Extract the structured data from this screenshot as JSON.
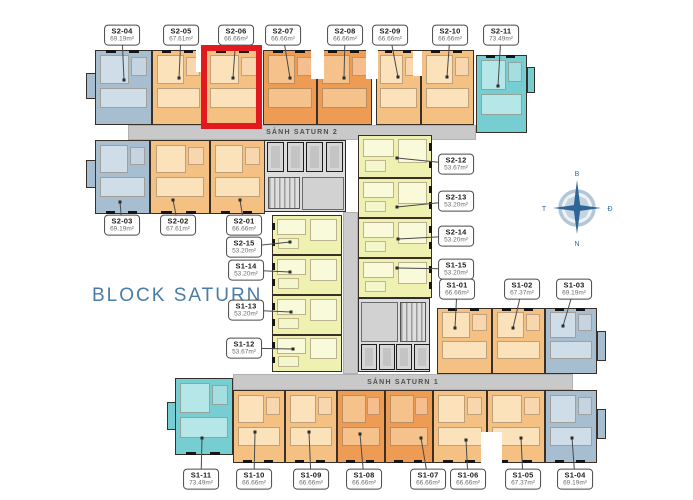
{
  "title": "BLOCK SATURN",
  "compass": {
    "north": "B",
    "east": "Đ",
    "south": "N",
    "west": "T"
  },
  "highlight": {
    "unit": "S2-06",
    "color": "#e2191f",
    "x": 201,
    "y": 45,
    "w": 61,
    "h": 84
  },
  "halls": [
    {
      "label": "SẢNH SATURN 2",
      "x": 128,
      "y": 125,
      "w": 348,
      "h": 15
    },
    {
      "label": "SẢNH SATURN 1",
      "x": 233,
      "y": 374,
      "w": 340,
      "h": 16
    }
  ],
  "corridor": {
    "x": 343,
    "y": 212,
    "w": 15,
    "h": 162
  },
  "colors": {
    "blue": "#a6bed0",
    "blue_light": "#cfdde8",
    "tan": "#f4c183",
    "tan_light": "#fbe2ba",
    "orange": "#ee9c54",
    "orange_light": "#f6c28b",
    "teal": "#76cdd2",
    "teal_light": "#b5e6e8",
    "yellow": "#eff1b0",
    "yellow_light": "#f9fad9",
    "hall": "#c9c9c9",
    "core": "#dcdcdc",
    "wall": "#3a2f26",
    "red": "#e2191f",
    "brand": "#4b7ca6"
  },
  "units": [
    {
      "code": "S2-04",
      "area": "69.19m²",
      "color": "blue",
      "x": 95,
      "y": 50,
      "w": 57,
      "h": 75,
      "facade": "top",
      "label": {
        "x": 122,
        "y": 35
      },
      "dot": {
        "x": 124,
        "y": 80
      }
    },
    {
      "code": "S2-05",
      "area": "67.61m²",
      "color": "tan",
      "x": 152,
      "y": 50,
      "w": 53,
      "h": 75,
      "facade": "top",
      "label": {
        "x": 181,
        "y": 35
      },
      "dot": {
        "x": 179,
        "y": 78
      }
    },
    {
      "code": "S2-06",
      "area": "66.66m²",
      "color": "tan",
      "x": 205,
      "y": 50,
      "w": 57,
      "h": 75,
      "facade": "top",
      "label": {
        "x": 236,
        "y": 35
      },
      "dot": {
        "x": 233,
        "y": 78
      }
    },
    {
      "code": "S2-07",
      "area": "66.66m²",
      "color": "orange",
      "x": 263,
      "y": 50,
      "w": 54,
      "h": 75,
      "facade": "top",
      "label": {
        "x": 283,
        "y": 35
      },
      "dot": {
        "x": 290,
        "y": 78
      }
    },
    {
      "code": "S2-08",
      "area": "66.66m²",
      "color": "orange",
      "x": 317,
      "y": 50,
      "w": 55,
      "h": 75,
      "facade": "top",
      "label": {
        "x": 345,
        "y": 35
      },
      "dot": {
        "x": 344,
        "y": 78
      }
    },
    {
      "code": "S2-09",
      "area": "66.66m²",
      "color": "tan",
      "x": 376,
      "y": 50,
      "w": 45,
      "h": 75,
      "facade": "top",
      "label": {
        "x": 390,
        "y": 35
      },
      "dot": {
        "x": 398,
        "y": 77
      }
    },
    {
      "code": "S2-10",
      "area": "66.66m²",
      "color": "tan",
      "x": 421,
      "y": 50,
      "w": 53,
      "h": 75,
      "facade": "top",
      "label": {
        "x": 450,
        "y": 35
      },
      "dot": {
        "x": 447,
        "y": 77
      }
    },
    {
      "code": "S2-11",
      "area": "73.49m²",
      "color": "teal",
      "x": 476,
      "y": 55,
      "w": 51,
      "h": 78,
      "facade": "top",
      "label": {
        "x": 501,
        "y": 35
      },
      "dot": {
        "x": 498,
        "y": 86
      }
    },
    {
      "code": "S2-03",
      "area": "69.19m²",
      "color": "blue",
      "x": 95,
      "y": 140,
      "w": 55,
      "h": 74,
      "facade": "bottom",
      "label": {
        "x": 122,
        "y": 225
      },
      "dot": {
        "x": 120,
        "y": 202
      }
    },
    {
      "code": "S2-02",
      "area": "67.61m²",
      "color": "tan",
      "x": 150,
      "y": 140,
      "w": 60,
      "h": 74,
      "facade": "bottom",
      "label": {
        "x": 178,
        "y": 225
      },
      "dot": {
        "x": 173,
        "y": 200
      }
    },
    {
      "code": "S2-01",
      "area": "66.66m²",
      "color": "tan",
      "x": 210,
      "y": 140,
      "w": 55,
      "h": 74,
      "facade": "bottom",
      "label": {
        "x": 244,
        "y": 225
      },
      "dot": {
        "x": 240,
        "y": 200
      }
    },
    {
      "code": "S2-15",
      "area": "53.20m²",
      "color": "yellow",
      "x": 272,
      "y": 215,
      "w": 70,
      "h": 40,
      "facade": "left",
      "label": {
        "x": 244,
        "y": 247
      },
      "dot": {
        "x": 290,
        "y": 242
      }
    },
    {
      "code": "S1-14",
      "area": "53.20m²",
      "color": "yellow",
      "x": 272,
      "y": 255,
      "w": 70,
      "h": 40,
      "facade": "left",
      "label": {
        "x": 246,
        "y": 270
      },
      "dot": {
        "x": 290,
        "y": 272
      }
    },
    {
      "code": "S1-13",
      "area": "53.20m²",
      "color": "yellow",
      "x": 272,
      "y": 295,
      "w": 70,
      "h": 40,
      "facade": "left",
      "label": {
        "x": 246,
        "y": 310
      },
      "dot": {
        "x": 291,
        "y": 312
      }
    },
    {
      "code": "S1-12",
      "area": "53.67m²",
      "color": "yellow",
      "x": 272,
      "y": 335,
      "w": 70,
      "h": 37,
      "facade": "left",
      "label": {
        "x": 244,
        "y": 348
      },
      "dot": {
        "x": 293,
        "y": 349
      }
    },
    {
      "code": "S2-12",
      "area": "53.67m²",
      "color": "yellow",
      "x": 358,
      "y": 135,
      "w": 74,
      "h": 43,
      "facade": "right",
      "label": {
        "x": 456,
        "y": 164
      },
      "dot": {
        "x": 397,
        "y": 158
      }
    },
    {
      "code": "S2-13",
      "area": "53.20m²",
      "color": "yellow",
      "x": 358,
      "y": 178,
      "w": 74,
      "h": 40,
      "facade": "right",
      "label": {
        "x": 456,
        "y": 201
      },
      "dot": {
        "x": 397,
        "y": 207
      }
    },
    {
      "code": "S2-14",
      "area": "53.20m²",
      "color": "yellow",
      "x": 358,
      "y": 218,
      "w": 74,
      "h": 40,
      "facade": "right",
      "label": {
        "x": 456,
        "y": 236
      },
      "dot": {
        "x": 398,
        "y": 239
      }
    },
    {
      "code": "S1-15",
      "area": "53.20m²",
      "color": "yellow",
      "x": 358,
      "y": 258,
      "w": 74,
      "h": 40,
      "facade": "right",
      "label": {
        "x": 456,
        "y": 269
      },
      "dot": {
        "x": 397,
        "y": 268
      }
    },
    {
      "code": "S1-01",
      "area": "66.66m²",
      "color": "tan",
      "x": 437,
      "y": 308,
      "w": 55,
      "h": 66,
      "facade": "top",
      "label": {
        "x": 457,
        "y": 289
      },
      "dot": {
        "x": 455,
        "y": 328
      }
    },
    {
      "code": "S1-02",
      "area": "67.37m²",
      "color": "tan",
      "x": 492,
      "y": 308,
      "w": 53,
      "h": 66,
      "facade": "top",
      "label": {
        "x": 522,
        "y": 289
      },
      "dot": {
        "x": 513,
        "y": 328
      }
    },
    {
      "code": "S1-03",
      "area": "69.19m²",
      "color": "blue",
      "x": 545,
      "y": 308,
      "w": 52,
      "h": 66,
      "facade": "top",
      "label": {
        "x": 574,
        "y": 289
      },
      "dot": {
        "x": 563,
        "y": 326
      }
    },
    {
      "code": "S1-11",
      "area": "73.49m²",
      "color": "teal",
      "x": 175,
      "y": 378,
      "w": 58,
      "h": 77,
      "facade": "bottom",
      "label": {
        "x": 201,
        "y": 479
      },
      "dot": {
        "x": 202,
        "y": 438
      }
    },
    {
      "code": "S1-10",
      "area": "66.66m²",
      "color": "tan",
      "x": 233,
      "y": 390,
      "w": 52,
      "h": 73,
      "facade": "bottom",
      "label": {
        "x": 254,
        "y": 479
      },
      "dot": {
        "x": 255,
        "y": 432
      }
    },
    {
      "code": "S1-09",
      "area": "66.66m²",
      "color": "tan",
      "x": 285,
      "y": 390,
      "w": 52,
      "h": 73,
      "facade": "bottom",
      "label": {
        "x": 311,
        "y": 479
      },
      "dot": {
        "x": 309,
        "y": 432
      }
    },
    {
      "code": "S1-08",
      "area": "66.66m²",
      "color": "orange",
      "x": 337,
      "y": 390,
      "w": 48,
      "h": 73,
      "facade": "bottom",
      "label": {
        "x": 364,
        "y": 479
      },
      "dot": {
        "x": 360,
        "y": 434
      }
    },
    {
      "code": "S1-07",
      "area": "66.66m²",
      "color": "orange",
      "x": 385,
      "y": 390,
      "w": 48,
      "h": 73,
      "facade": "bottom",
      "label": {
        "x": 428,
        "y": 479
      },
      "dot": {
        "x": 421,
        "y": 438
      }
    },
    {
      "code": "S1-06",
      "area": "66.66m²",
      "color": "tan",
      "x": 433,
      "y": 390,
      "w": 54,
      "h": 73,
      "facade": "bottom",
      "label": {
        "x": 468,
        "y": 479
      },
      "dot": {
        "x": 466,
        "y": 440
      }
    },
    {
      "code": "S1-05",
      "area": "67.37m²",
      "color": "tan",
      "x": 487,
      "y": 390,
      "w": 58,
      "h": 73,
      "facade": "bottom",
      "label": {
        "x": 523,
        "y": 479
      },
      "dot": {
        "x": 521,
        "y": 438
      }
    },
    {
      "code": "S1-04",
      "area": "69.19m²",
      "color": "blue",
      "x": 545,
      "y": 390,
      "w": 52,
      "h": 73,
      "facade": "bottom",
      "label": {
        "x": 575,
        "y": 479
      },
      "dot": {
        "x": 572,
        "y": 438
      }
    }
  ],
  "cores": [
    {
      "x": 264,
      "y": 140,
      "w": 82,
      "h": 72,
      "elevators": {
        "x": 267,
        "y": 142,
        "count": 4,
        "cw": 17,
        "ch": 30,
        "gap": 19.5
      },
      "stairs": {
        "x": 268,
        "y": 177,
        "w": 32,
        "h": 32
      },
      "room": {
        "x": 302,
        "y": 177,
        "w": 42,
        "h": 33
      }
    },
    {
      "x": 358,
      "y": 298,
      "w": 72,
      "h": 74,
      "elevators": {
        "x": 361,
        "y": 344,
        "count": 4,
        "cw": 16,
        "ch": 26,
        "gap": 17.5
      },
      "stairs": {
        "x": 400,
        "y": 302,
        "w": 26,
        "h": 40
      },
      "room": {
        "x": 361,
        "y": 302,
        "w": 37,
        "h": 40
      }
    }
  ],
  "nubs": [
    {
      "color": "blue",
      "x": 86,
      "y": 73,
      "w": 10,
      "h": 26
    },
    {
      "color": "blue",
      "x": 86,
      "y": 160,
      "w": 10,
      "h": 28
    },
    {
      "color": "blue",
      "x": 597,
      "y": 331,
      "w": 9,
      "h": 30
    },
    {
      "color": "blue",
      "x": 597,
      "y": 409,
      "w": 9,
      "h": 30
    },
    {
      "color": "teal",
      "x": 527,
      "y": 67,
      "w": 8,
      "h": 26
    },
    {
      "color": "teal",
      "x": 167,
      "y": 402,
      "w": 9,
      "h": 28
    }
  ],
  "notches": [
    {
      "x": 196,
      "y": 49,
      "w": 10,
      "h": 23
    },
    {
      "x": 311,
      "y": 49,
      "w": 13,
      "h": 30
    },
    {
      "x": 366,
      "y": 49,
      "w": 12,
      "h": 30
    },
    {
      "x": 413,
      "y": 51,
      "w": 9,
      "h": 25
    },
    {
      "x": 481,
      "y": 432,
      "w": 21,
      "h": 32
    }
  ]
}
